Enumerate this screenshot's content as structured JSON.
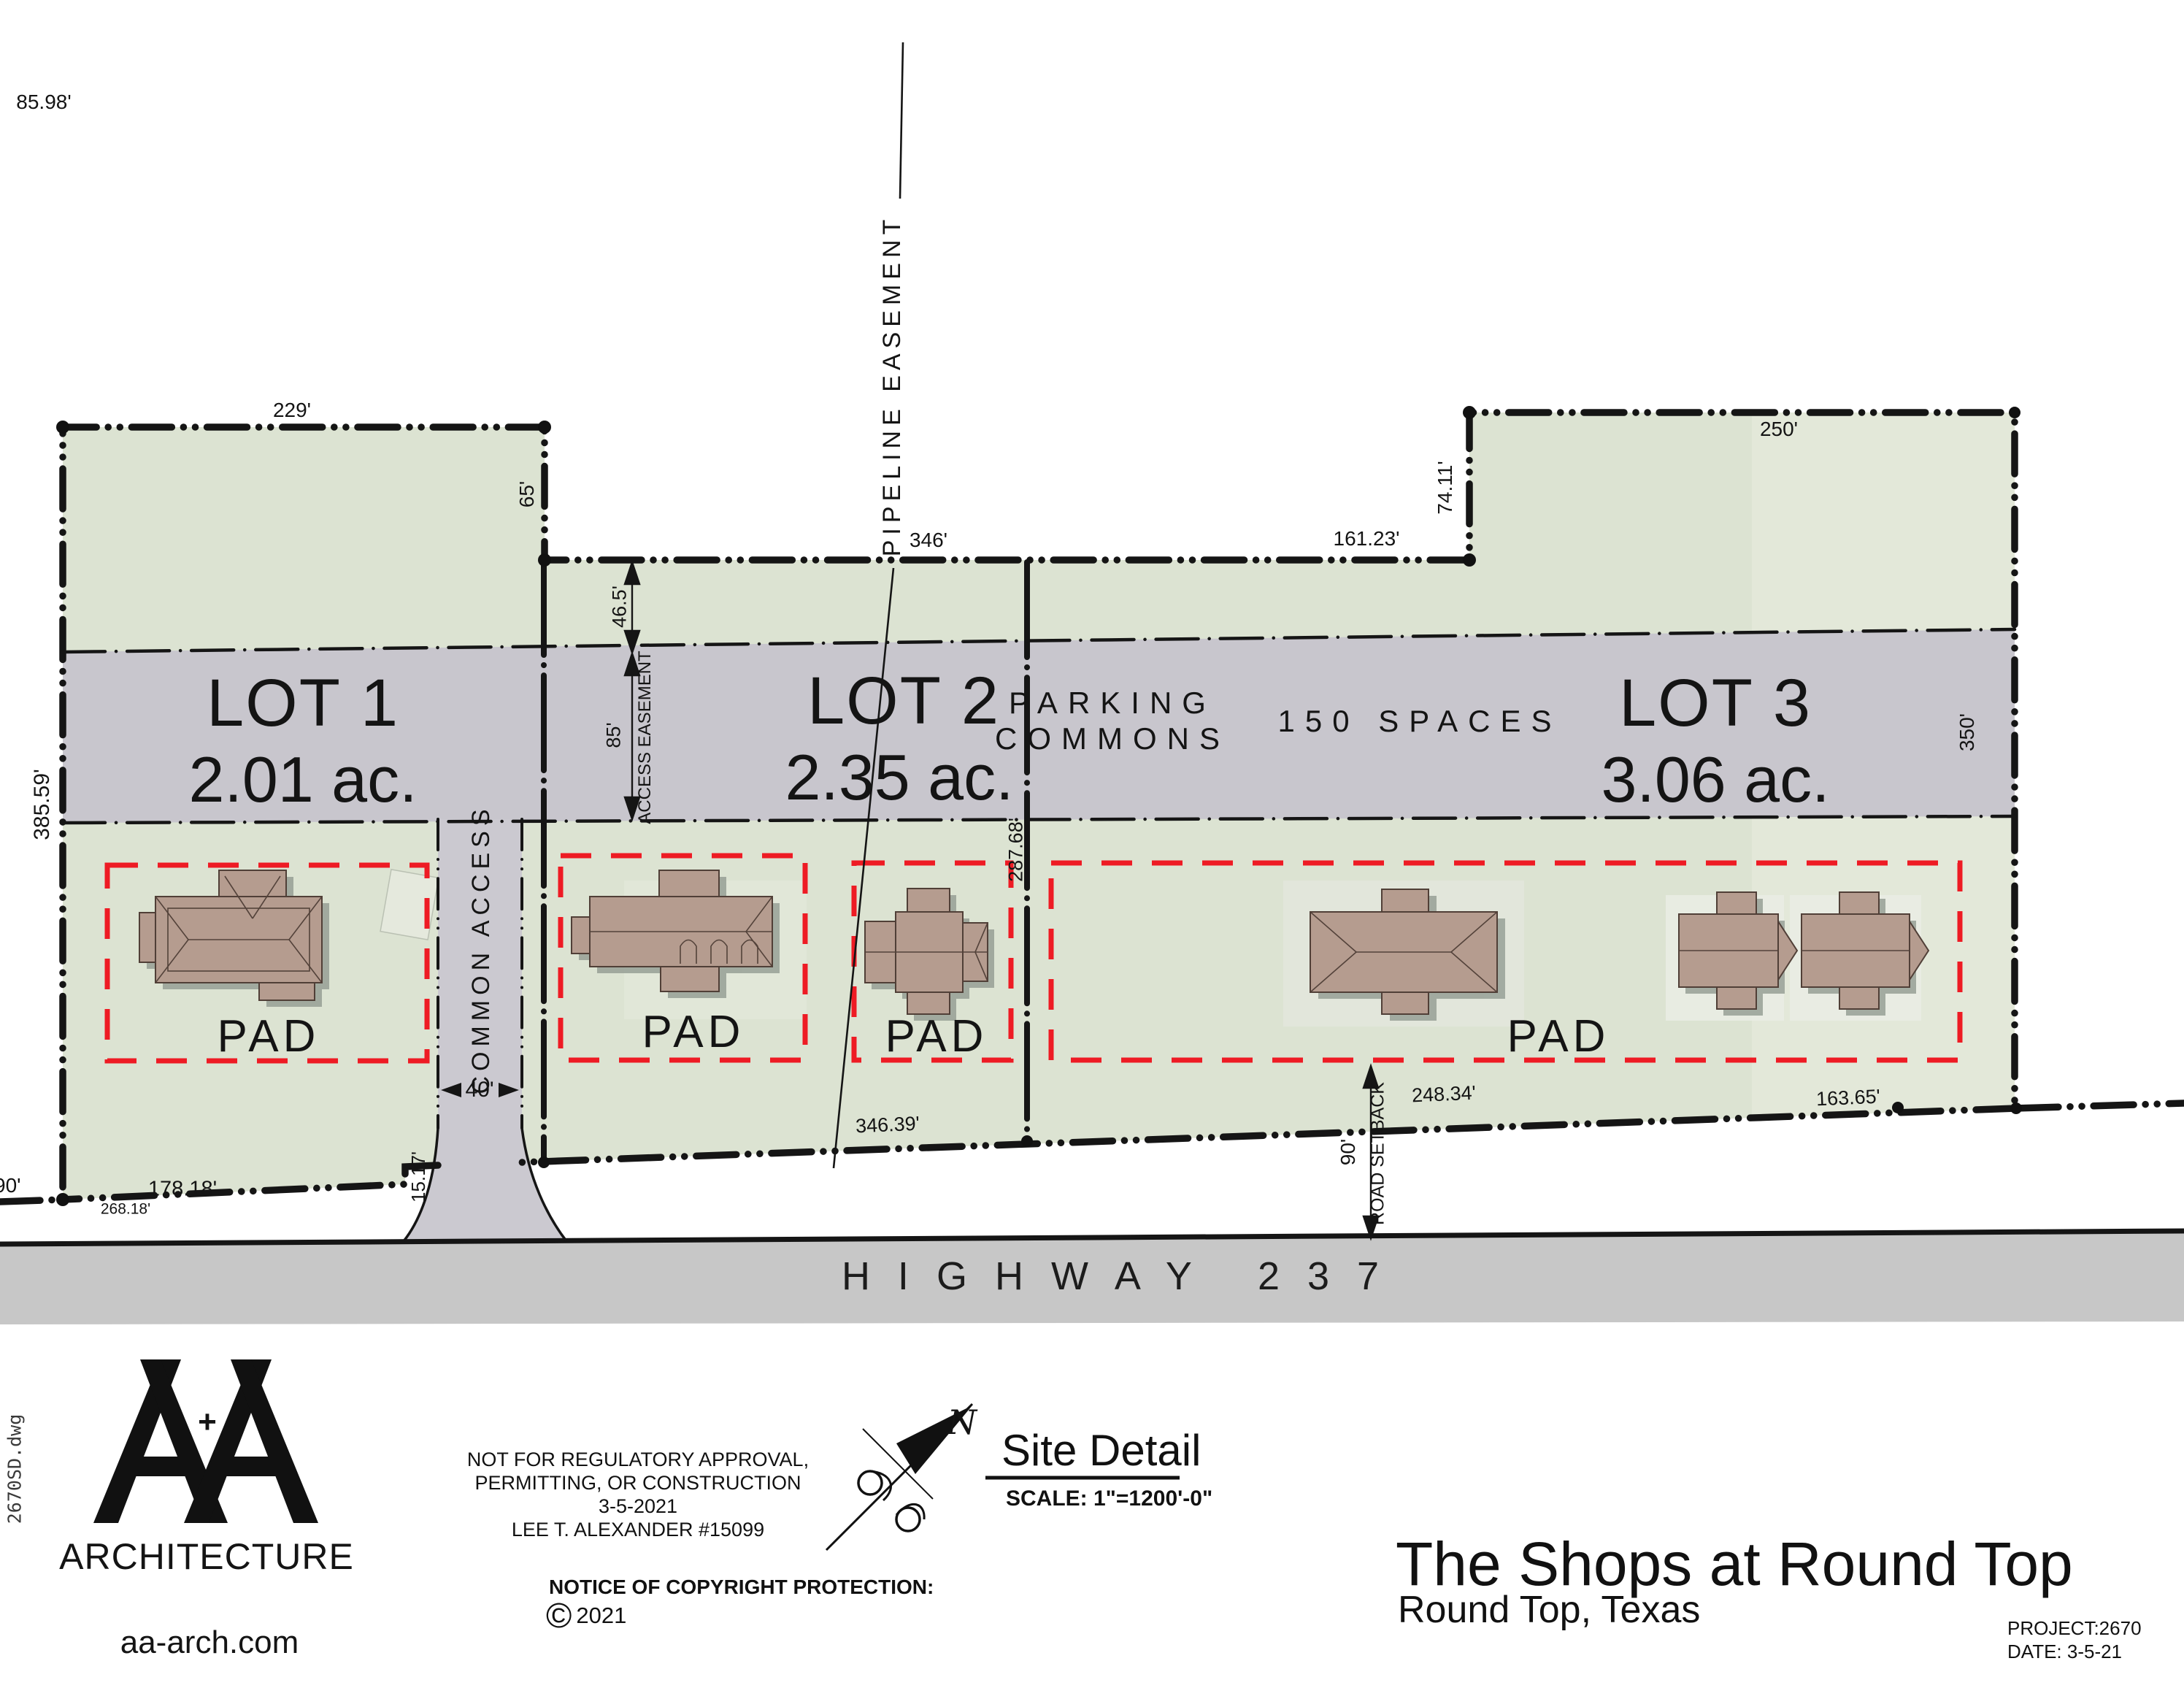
{
  "drawing": {
    "dims": {
      "d8598": "85.98'",
      "d229": "229'",
      "d65": "65'",
      "d346": "346'",
      "d16123": "161.23'",
      "d7411": "74.11'",
      "d250": "250'",
      "d350": "350'",
      "d38559": "385.59'",
      "d465": "46.5'",
      "d85": "85'",
      "access_easement": "ACCESS EASEMENT",
      "d28768": "287.68'",
      "d90_left": "90'",
      "d17818": "178.18'",
      "d26818": "268.18'",
      "d1517": "15.17'",
      "d40": "40'",
      "d34639": "346.39'",
      "d90_setback": "90'",
      "road_setback": "ROAD SETBACK",
      "d24834": "248.34'",
      "d16365": "163.65'"
    },
    "pipeline_label": "PIPELINE EASEMENT",
    "common_access": "COMMON ACCESS",
    "lots": {
      "lot1": {
        "name": "LOT 1",
        "area": "2.01 ac."
      },
      "lot2": {
        "name": "LOT 2",
        "area": "2.35 ac."
      },
      "lot3": {
        "name": "LOT 3",
        "area": "3.06 ac."
      },
      "parking_line1": "PARKING",
      "parking_line2": "COMMONS",
      "spaces": "150 SPACES",
      "pad": "PAD"
    },
    "highway": "HIGHWAY 237",
    "colors": {
      "parcel_green": "#dce3d2",
      "parcel_green_light": "#e4e9db",
      "commons_gray": "#c8c6cd",
      "highway_gray": "#c7c7c7",
      "pad_red": "#ee1b24",
      "building_tan": "#b59c8f",
      "line_black": "#151515"
    }
  },
  "titleblock": {
    "project_title": "The Shops at Round Top",
    "project_location": "Round Top, Texas",
    "project_no": "PROJECT:2670",
    "date": "DATE: 3-5-21"
  },
  "notes": {
    "line1": "NOT FOR REGULATORY APPROVAL,",
    "line2": "PERMITTING, OR CONSTRUCTION",
    "line3": "3-5-2021",
    "line4": "LEE T. ALEXANDER #15099",
    "copyright_heading": "NOTICE OF COPYRIGHT PROTECTION:",
    "copyright_symbol": "©",
    "copyright_year": "2021"
  },
  "sitedetail": {
    "north": "N",
    "title": "Site Detail",
    "scale": "SCALE: 1\"=1200'-0\""
  },
  "logo": {
    "mark": "A+A",
    "plus": "+",
    "firm": "ARCHITECTURE",
    "website": "aa-arch.com",
    "file": "2670SD.dwg"
  }
}
